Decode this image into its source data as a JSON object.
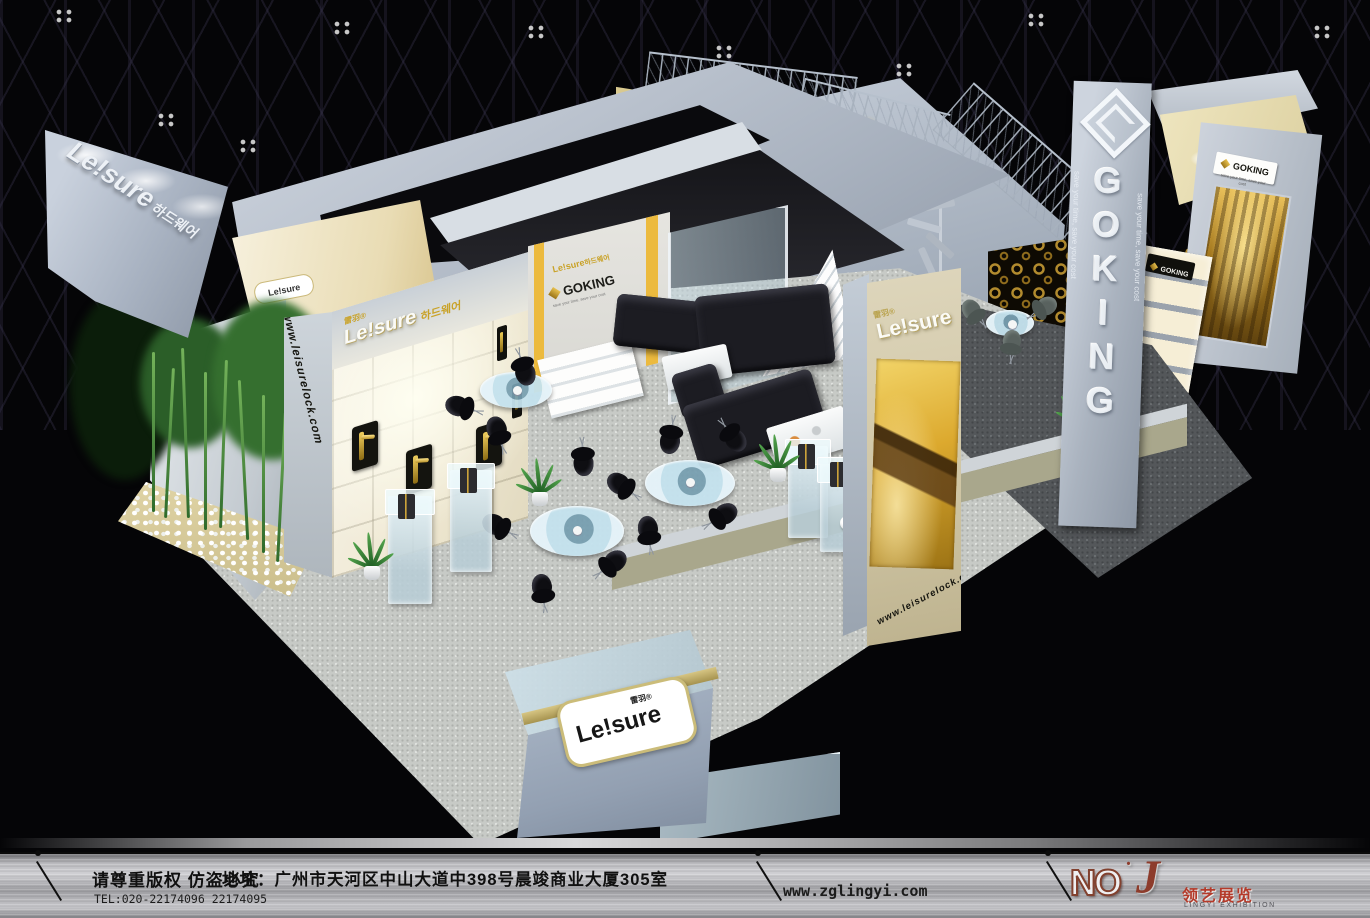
{
  "scene": {
    "description": "3D render of an exhibition booth in a dark hall, viewed from above"
  },
  "brands": {
    "leisure": {
      "logo": "Le!sure",
      "cn": "雷羽",
      "reg": "®",
      "kr": "하드웨어",
      "url": "www.leisurelock.com"
    },
    "goking": {
      "logo": "GOKING",
      "tagline": "save your time, save your cost"
    }
  },
  "footer": {
    "notice": "请尊重版权 仿盗必究",
    "tel": "TEL:020-22174096 22174095",
    "address": "地址：广州市天河区中山大道中398号晨竣商业大厦305室",
    "site": "www.zglingyi.com",
    "brand_no": "NO",
    "brand_dot": ".",
    "brand_j": "J",
    "brand_cn": "领艺展览",
    "brand_en": "LINGYI EXHIBITION"
  },
  "colors": {
    "accent_gold": "#c9a227",
    "booth_panel": "#b7c0cc",
    "carpet_light": "#c7cac6",
    "carpet_dark": "#54575a",
    "beige_column": "#d6cdb0",
    "olive_fascia": "#a9a78c",
    "logo_red": "#b43a2a"
  }
}
